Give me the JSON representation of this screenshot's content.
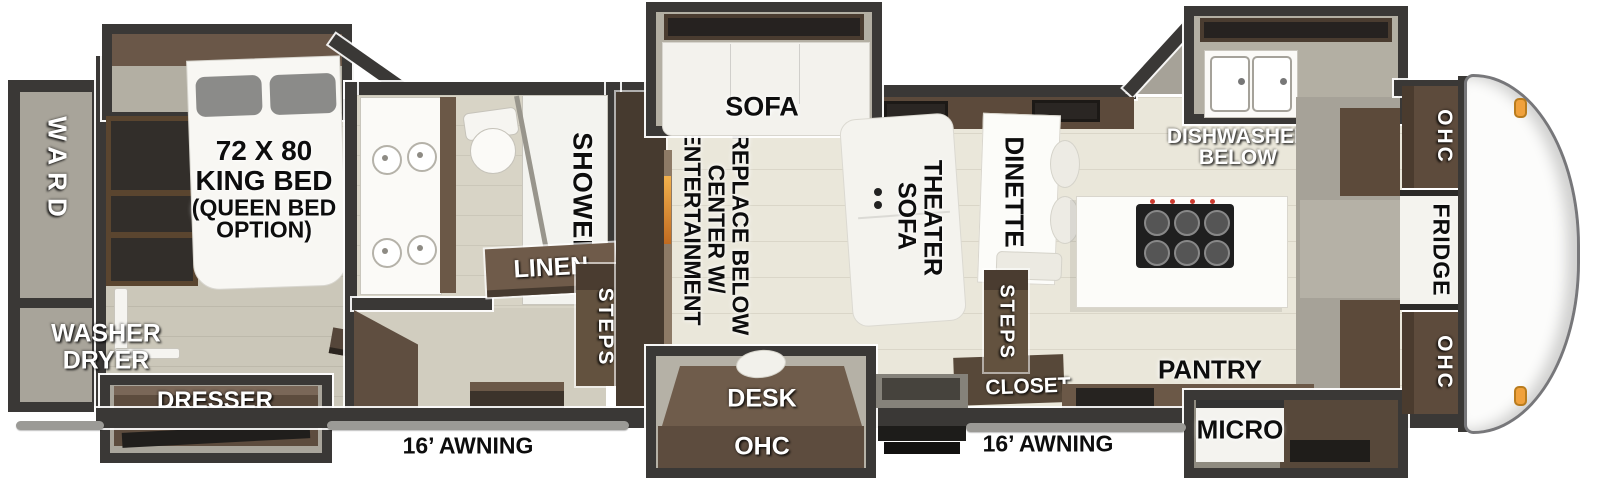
{
  "floorplan": {
    "rear": {
      "ward": "WARD",
      "washer_dryer_lines": [
        "WASHER",
        "DRYER"
      ]
    },
    "bedroom": {
      "bed_lines": [
        "72 X 80",
        "KING BED",
        "(QUEEN BED",
        "OPTION)"
      ],
      "dresser": "DRESSER",
      "tv": "TV"
    },
    "bathroom": {
      "shower": "SHOWER",
      "linen": "LINEN",
      "steps": "STEPS"
    },
    "living": {
      "sofa": "SOFA",
      "entertainment_lines": [
        "ENTERTAINMENT",
        "CENTER W/",
        "FIREPLACE BELOW"
      ],
      "theater_lines": [
        "THEATER",
        "SOFA"
      ],
      "desk": "DESK",
      "desk_ohc": "OHC"
    },
    "dinette": {
      "label": "DINETTE",
      "steps": "STEPS",
      "closet": "CLOSET"
    },
    "kitchen": {
      "dishwasher_lines": [
        "DISHWASHER",
        "BELOW"
      ],
      "pantry": "PANTRY",
      "micro": "MICRO"
    },
    "front": {
      "ohc_top": "OHC",
      "fridge": "FRIDGE",
      "ohc_bottom": "OHC"
    },
    "exterior": {
      "awning_left": "16’ AWNING",
      "awning_right": "16’ AWNING"
    }
  },
  "colors": {
    "wall": "#3a3836",
    "floor_main": "#eae7da",
    "floor_bedroom": "#cbc7b9",
    "cabinet_brown": "#6b5847",
    "cabinet_dark": "#4f4136",
    "fixture_white": "#f6f5f1",
    "marker_light_orange": "#f0a13c",
    "awning_grey": "#9b9a96"
  }
}
